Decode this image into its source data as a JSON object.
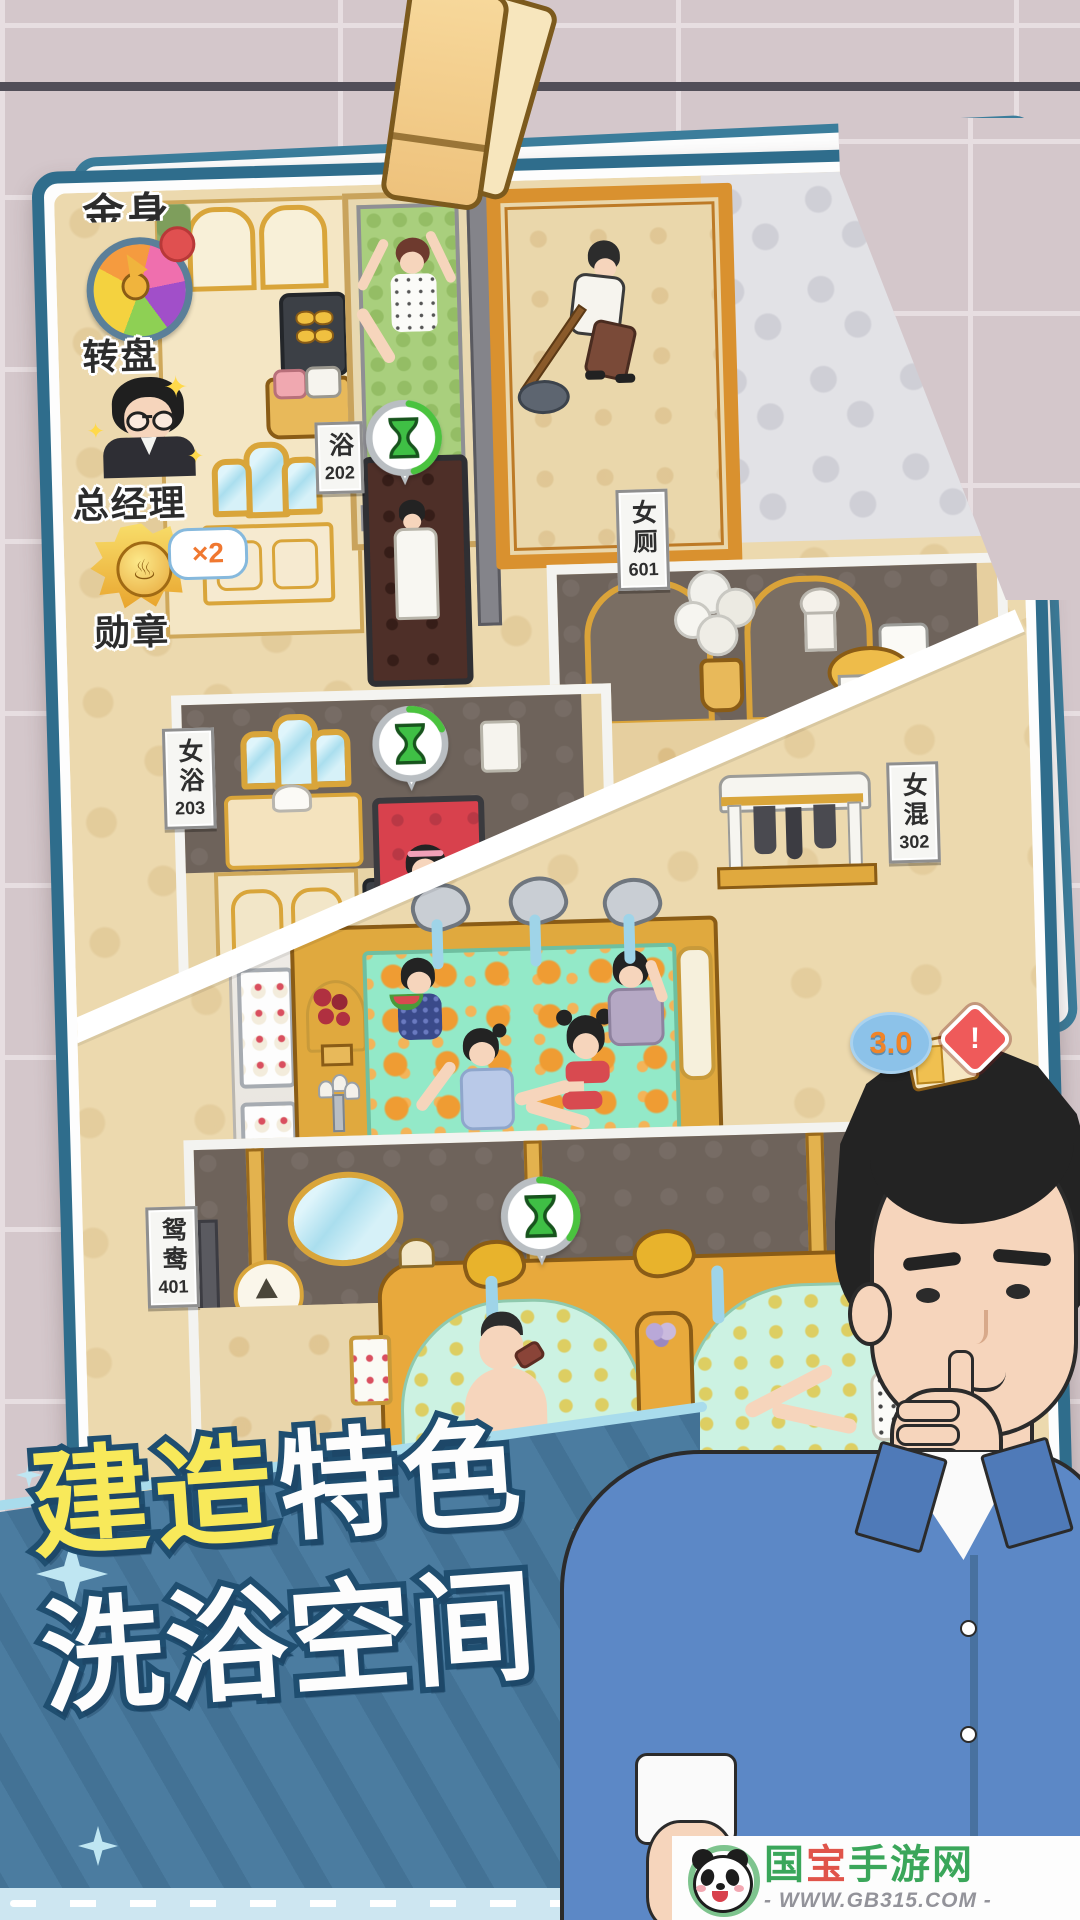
{
  "photo_hud": {
    "top_partial_label": "金身",
    "wheel_label": "转盘",
    "manager_label": "总经理",
    "medal_label": "勋章",
    "medal_multiplier": "×2"
  },
  "room_signs": {
    "bath202": {
      "chars": "浴",
      "num": "202"
    },
    "toilet601": {
      "chars": "女厕",
      "num": "601"
    },
    "bath203": {
      "chars": "女浴",
      "num": "203"
    },
    "mixed302": {
      "chars": "女混",
      "num": "302"
    },
    "couple401": {
      "chars": "鸳鸯",
      "num": "401"
    }
  },
  "badges": {
    "rating": "3.0",
    "warning": "!"
  },
  "banner": {
    "line1_highlight": "建造",
    "line1_rest": "特色",
    "line2": "洗浴空间"
  },
  "logo": {
    "name_part1": "国",
    "name_part2": "宝",
    "name_part3": "手游网",
    "url": "- WWW.GB315.COM -"
  },
  "icons": {
    "wheel": "prize-wheel",
    "notification": "red-dot",
    "manager": "manager-avatar",
    "medal": "hot-spring-medal",
    "hourglass": "hourglass-timer",
    "rating": "rating-bubble",
    "warning": "exclamation-warning",
    "panda": "panda-mascot",
    "clothespin": "clothespin"
  },
  "colors": {
    "photo_border": "#2f6d8c",
    "banner_blue": "#4b7ca0",
    "banner_yellow": "#f8e95a",
    "hourglass_green": "#3fbf45",
    "rating_orange": "#f08428",
    "warning_red": "#ef5a5a",
    "logo_green": "#3aa65a",
    "logo_red": "#e0544a",
    "pool_green": "#93e9c8",
    "bath_red": "#d8414d"
  }
}
